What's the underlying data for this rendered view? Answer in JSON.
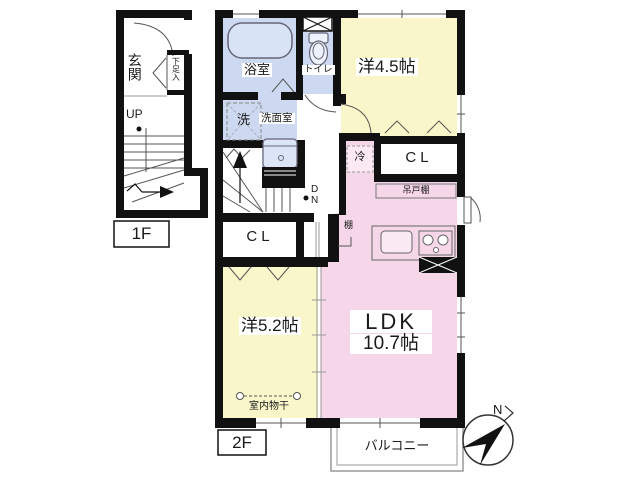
{
  "plan": {
    "floor1": {
      "label": "1F",
      "entrance": "玄関",
      "shoe_cabinet": "下足入",
      "up": "UP"
    },
    "floor2": {
      "label": "2F",
      "bath": "浴室",
      "toilet": "トイレ",
      "washer": "洗",
      "washroom": "洗面室",
      "room_4_5": "洋4.5帖",
      "room_5_2": "洋5.2帖",
      "ldk_name": "LDK",
      "ldk_size": "10.7帖",
      "closet_upper": "CL",
      "closet_lower": "CL",
      "hanging_cupboard": "吊戸棚",
      "shelf": "棚",
      "fridge": "冷",
      "indoor_drying": "室内物干",
      "down_d": "D",
      "down_n": "N",
      "balcony": "バルコニー"
    },
    "compass_north": "N"
  },
  "colors": {
    "wall": "#111111",
    "room_blue": "#ccd9f1",
    "room_yellow": "#f9f6c9",
    "room_pink": "#f6d7e9",
    "fridge_pink": "#fce9f4"
  }
}
